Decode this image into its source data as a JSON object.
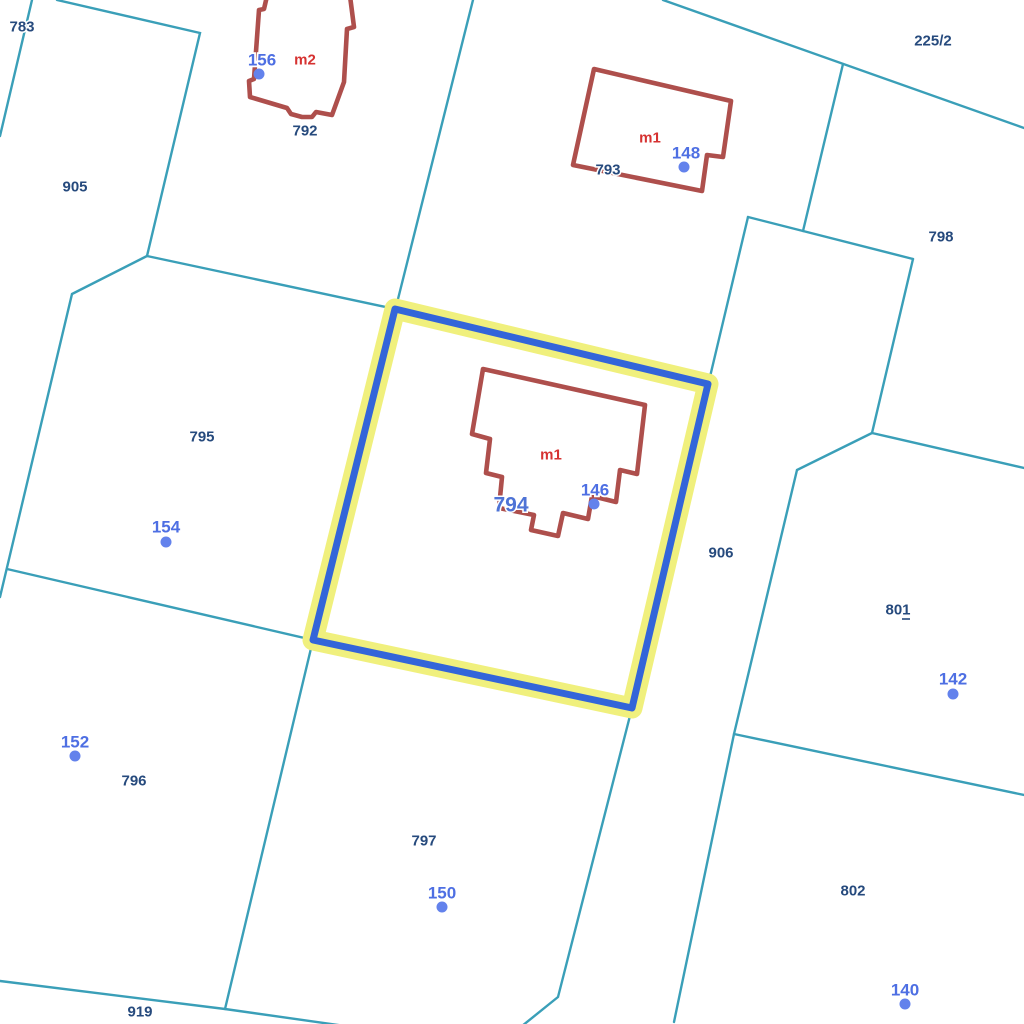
{
  "map": {
    "colors": {
      "background": "#ffffff",
      "boundary_line": "#3a9fb8",
      "building_outline": "#ae4f4c",
      "building_label": "#d63231",
      "parcel_label": "#264a7d",
      "address_label": "#4e6fe3",
      "address_dot": "#6382ec",
      "selected_outline": "#3365d9",
      "selected_halo": "#f0f07d",
      "selected_parcel_label": "#4e73d6"
    },
    "parcel_labels": [
      {
        "text": "783"
      },
      {
        "text": "905"
      },
      {
        "text": "792"
      },
      {
        "text": "793"
      },
      {
        "text": "225/2"
      },
      {
        "text": "798"
      },
      {
        "text": "795"
      },
      {
        "text": "906"
      },
      {
        "text": "801"
      },
      {
        "text": "796"
      },
      {
        "text": "797"
      },
      {
        "text": "802"
      },
      {
        "text": "919"
      }
    ],
    "building_labels": [
      {
        "text": "m2"
      },
      {
        "text": "m1"
      },
      {
        "text": "m1"
      }
    ],
    "selected_parcel": {
      "label": "794"
    },
    "address_points": [
      {
        "number": "156"
      },
      {
        "number": "148"
      },
      {
        "number": "146"
      },
      {
        "number": "154"
      },
      {
        "number": "152"
      },
      {
        "number": "142"
      },
      {
        "number": "150"
      },
      {
        "number": "140"
      }
    ]
  }
}
